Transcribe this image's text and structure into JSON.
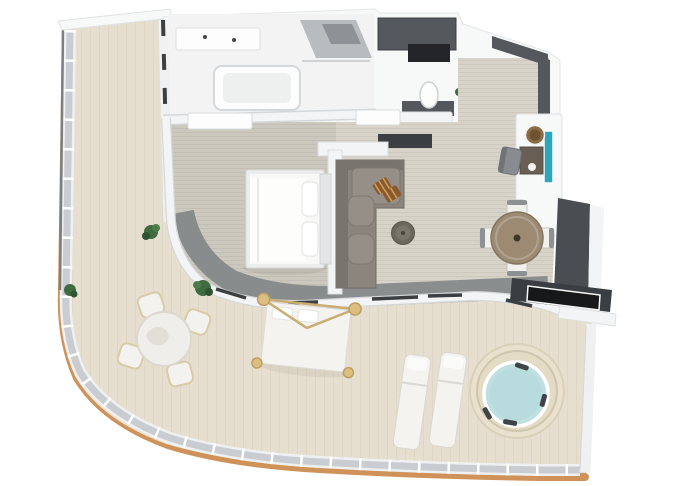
{
  "scene": {
    "type": "3d-floorplan-top-view",
    "rooms": [
      {
        "name": "bathroom",
        "items": [
          "double-vanity",
          "bathtub",
          "shower"
        ]
      },
      {
        "name": "wc-dressing",
        "items": [
          "wardrobe",
          "toilet",
          "vanity-counter",
          "plant"
        ]
      },
      {
        "name": "entry-hall",
        "items": [
          "entry-door-walls"
        ]
      },
      {
        "name": "bedroom",
        "items": [
          "double-bed",
          "pillows",
          "headboard"
        ]
      },
      {
        "name": "living-room",
        "items": [
          "l-shaped-sofa",
          "brown-pillows",
          "round-pouf",
          "dining-table",
          "dining-chairs",
          "desk",
          "desk-chair",
          "stool",
          "teal-mirror",
          "tv-media-wall"
        ]
      },
      {
        "name": "wraparound-terrace",
        "items": [
          "outdoor-dining-table",
          "outdoor-chairs",
          "canopy-daybed",
          "sun-loungers",
          "jacuzzi",
          "plants",
          "glass-railing"
        ]
      }
    ]
  },
  "colors": {
    "background": "#ffffff",
    "deck": "#e6dfcf",
    "deck_light": "#ece5d4",
    "rim_orange": "#cf9258",
    "railing_white": "#eef0f1",
    "railing_glass": "#c9cdd2",
    "edge_dark": "#7b7e82",
    "slab_white": "#f7f8f8",
    "wall_white": "#f3f4f5",
    "wall_edge": "#d5d8da",
    "carpet": "#d7d3c8",
    "bedroom_tint": "rgba(120,123,123,0.12)",
    "walkway": "#7e8184",
    "glass_dark": "#3c3f42",
    "dark_wall": "#54575c",
    "shelf_black": "#232528",
    "media_wall": "#4a4e53",
    "tv_unit": "#3a3d41",
    "tv_screen": "#17181a",
    "bath_floor": "#f2f3f2",
    "fixture_white": "#fdfdfd",
    "shower_gray": "#b9bcbf",
    "shower_dark": "#8e9296",
    "bed_frame": "#eceded",
    "bed_white": "#f8f8f6",
    "duvet": "#fdfdfc",
    "headboard": "#e4e5e5",
    "sofa": "#8b857d",
    "sofa_dark": "#79746d",
    "sofa_cushion": "#968f87",
    "pillow_brown": "#8a5a2e",
    "pillow_stripe": "#cfa05e",
    "pouf": "#6b675c",
    "pouf_top": "#79756a",
    "table_brown": "#9c8a72",
    "table_edge": "#83745f",
    "chair_seat": "#f1f0ed",
    "chair_back": "#8e9194",
    "desk_brown": "#695e54",
    "stool_brown": "#8a6b44",
    "teal": "#2ba6bd",
    "gray_chair": "#888b8f",
    "marble": "#f0eeea",
    "outdoor_chair": "#f4f2ee",
    "outdoor_frame": "#d9cba8",
    "gold": "#dcbe80",
    "gold_dark": "#bfa063",
    "lounger": "#f4f3ef",
    "tub_ring": "#e9e1cd",
    "tub_ring_edge": "#cfc6ae",
    "water": "#bfdfe1",
    "headrest": "#3f4448",
    "plant_dark": "#2f5233",
    "plant_mid": "#3e6b40",
    "plant_light": "#4e7d4a",
    "sill_white": "#fdfdfd"
  }
}
